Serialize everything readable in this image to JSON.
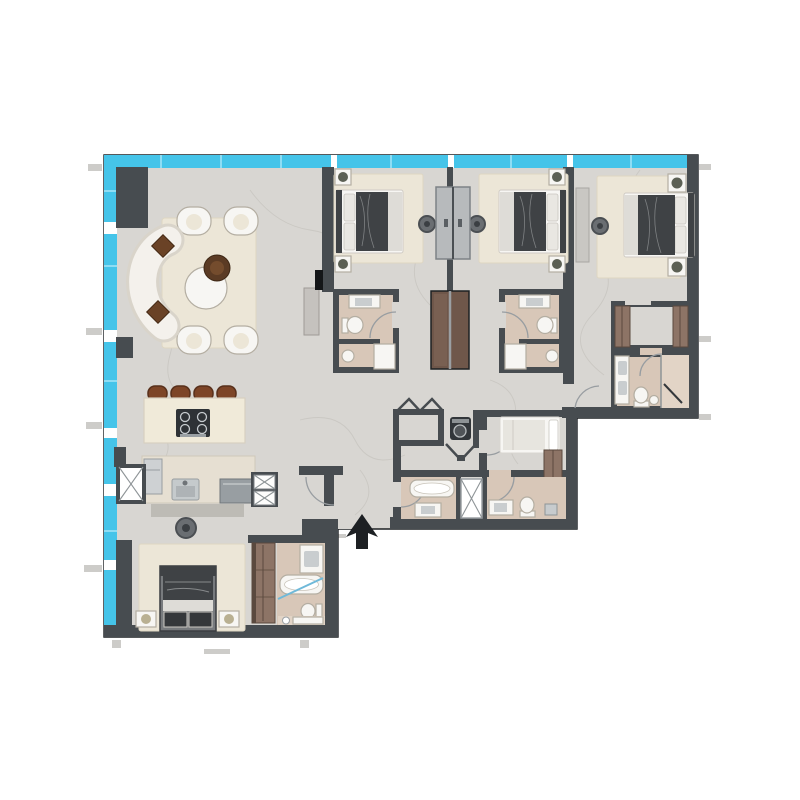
{
  "meta": {
    "content_type": "architectural floor plan (no text labels rendered in image)",
    "entry_marker": "solid dark arrow pointing up into the unit at the bottom-center entrance"
  },
  "palette": {
    "paper": "#ffffff",
    "floor": "#d8d6d2",
    "vein": "#c6c3be",
    "wall": "#474c50",
    "ink": "#1d2023",
    "glass": "#45c4e9",
    "glass-joint": "#8eddf4",
    "rug": "#ece6d7",
    "rug-edge": "#ded6c2",
    "bath-floor": "#d8c7b8",
    "bath-floor2": "#e2d4c6",
    "fixture": "#f7f6f3",
    "fixture-stroke": "#b4aea2",
    "gray-fix": "#c7cbcd",
    "gray-fix-dark": "#8e9497",
    "appliance": "#9aa0a4",
    "dark-app": "#2e3236",
    "wood": "#8d7466",
    "wood-dark": "#5a493e",
    "closet-brown": "#6f574a",
    "stool": "#7d4527",
    "stool-dark": "#58301b",
    "bed-dark": "#3f4245",
    "bed-mid": "#787b7e",
    "bed-light": "#dedcd7",
    "pillow": "#e9e7e2",
    "plant": "#5c6054",
    "arc": "#989da1",
    "tick": "#cdccc9",
    "shadow": "#b7b4ae",
    "wardrobe-gray": "#b7babc",
    "glass-partition": "#6fb9d9"
  },
  "facade": {
    "glazing_sides": [
      "top",
      "left"
    ],
    "mullion_positions_top_x": [
      331,
      448,
      567
    ],
    "mullion_positions_left_y": [
      222,
      330,
      428,
      484,
      560
    ]
  },
  "rooms": [
    {
      "id": "living-dining",
      "features": [
        "curved sofa with two brown cushions",
        "round dining table with centerpiece",
        "4 dining chairs",
        "cream area rug",
        "tv and console on wall",
        "structural column"
      ]
    },
    {
      "id": "kitchen",
      "features": [
        "island with 4-burner hob",
        "4 brown bar stools",
        "counter with sink",
        "fridge",
        "built-in oven tower",
        "service shaft with x-brace",
        "ceiling fan"
      ]
    },
    {
      "id": "master-bedroom",
      "features": [
        "double bed, headboard on bottom wall",
        "2 nightstands",
        "cream rug",
        "full-height wardrobe"
      ]
    },
    {
      "id": "master-bathroom",
      "features": [
        "vanity",
        "bathtub",
        "toilet",
        "shower strip",
        "glass partition"
      ]
    },
    {
      "id": "bedroom-2",
      "features": [
        "double bed, headboard left",
        "2 nightstands",
        "cream rug",
        "shared back-to-back wardrobe",
        "ceiling fan"
      ]
    },
    {
      "id": "bathroom-2",
      "features": [
        "vanity",
        "toilet",
        "shower",
        "wash basin"
      ]
    },
    {
      "id": "bedroom-3",
      "features": [
        "double bed, headboard right",
        "2 nightstands",
        "cream rug",
        "shared back-to-back wardrobe",
        "ceiling fan"
      ]
    },
    {
      "id": "bathroom-3",
      "features": [
        "vanity",
        "toilet",
        "shower",
        "wash basin"
      ]
    },
    {
      "id": "bedroom-4",
      "features": [
        "double bed, headboard right",
        "2 nightstands with plants",
        "cream rug",
        "console dresser",
        "ceiling fan"
      ]
    },
    {
      "id": "walk-in-closet-4",
      "features": [
        "two wardrobe runs"
      ]
    },
    {
      "id": "bathroom-4",
      "features": [
        "double vanity",
        "toilet",
        "shower with glass door",
        "stool"
      ]
    },
    {
      "id": "hall-closet",
      "features": [
        "bi-fold door closet"
      ]
    },
    {
      "id": "laundry",
      "features": [
        "washing machine",
        "v-fold doors"
      ]
    },
    {
      "id": "maid-room",
      "features": [
        "single bed",
        "wardrobe"
      ]
    },
    {
      "id": "guest-bathroom",
      "features": [
        "bathtub",
        "sink"
      ]
    },
    {
      "id": "shower-cabin",
      "features": [
        "x-braced glass shower"
      ]
    },
    {
      "id": "bathroom-5",
      "features": [
        "sink",
        "toilet",
        "shelf"
      ]
    },
    {
      "id": "entrance",
      "features": [
        "door opening in bottom wall",
        "entry arrow"
      ]
    }
  ]
}
